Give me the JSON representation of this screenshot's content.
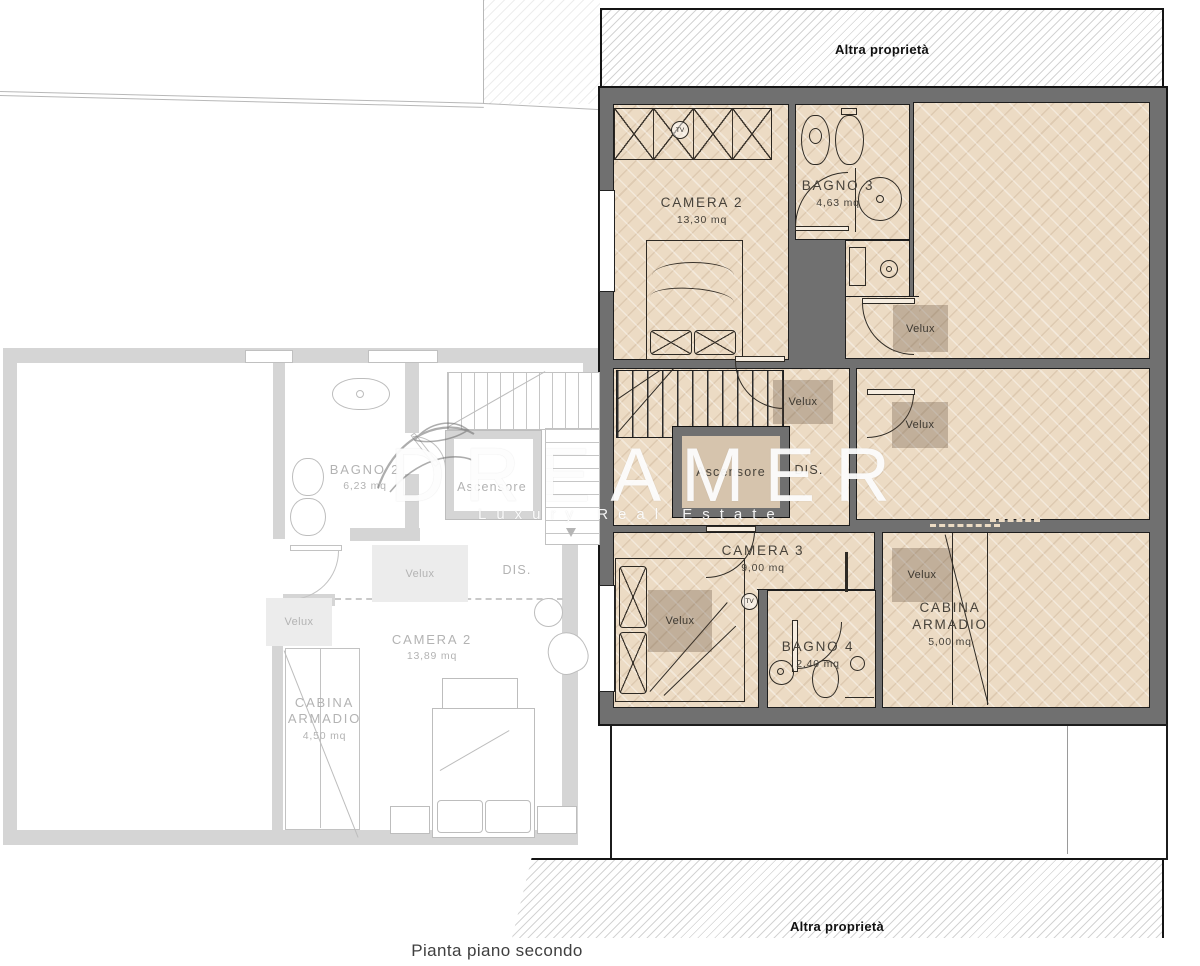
{
  "caption": "Pianta piano secondo",
  "boundary": {
    "top": "Altra proprietà",
    "bottom": "Altra proprietà"
  },
  "watermark": {
    "brand": "DREAMER",
    "tagline": "Luxury Real Estate"
  },
  "labels": {
    "skylight": "Velux",
    "elevator": "Ascensore",
    "hall": "DIS.",
    "tv": "TV"
  },
  "active_plan": {
    "camera2": {
      "name": "CAMERA 2",
      "area": "13,30 mq"
    },
    "bagno3": {
      "name": "BAGNO 3",
      "area": "4,63 mq"
    },
    "camera3": {
      "name": "CAMERA 3",
      "area": "9,00 mq"
    },
    "bagno4": {
      "name": "BAGNO 4",
      "area": "2,40 mq"
    },
    "cabina": {
      "name": "CABINA ARMADIO",
      "area": "5,00 mq"
    }
  },
  "background_plan": {
    "bagno2": {
      "name": "BAGNO 2",
      "area": "6,23 mq"
    },
    "camera2": {
      "name": "CAMERA 2",
      "area": "13,89 mq"
    },
    "cabina": {
      "name": "CABINA ARMADIO",
      "area": "4,50 mq"
    }
  },
  "colors": {
    "active_wall": "#707070",
    "floor": "#ecdbc4",
    "outline": "#1c1c1c",
    "faded_line": "#c3c3c3",
    "velux_overlay": "rgba(92,72,55,0.30)"
  }
}
